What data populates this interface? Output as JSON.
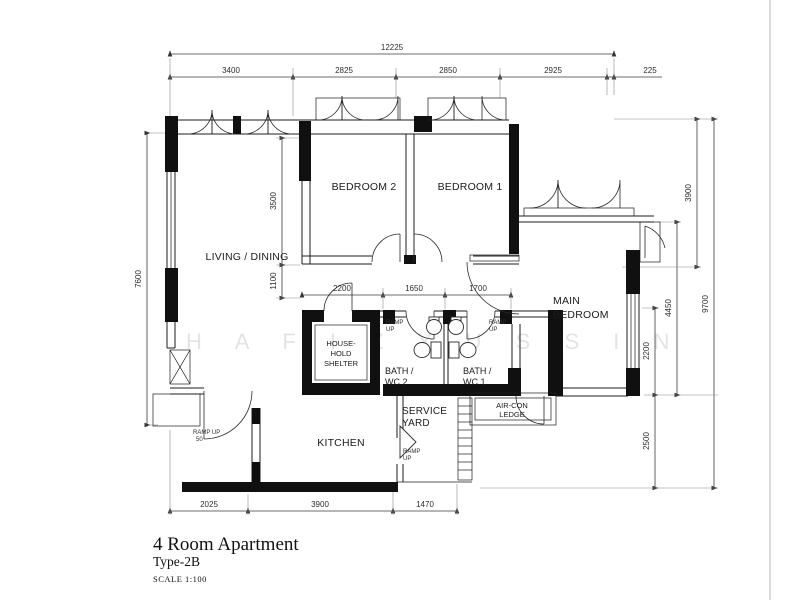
{
  "watermark": "H A F I Z   Y U S S I N",
  "title_block": {
    "title": "4 Room Apartment",
    "type_label": "Type-2B",
    "scale_label": "SCALE 1:100"
  },
  "rooms": {
    "living_dining": "LIVING / DINING",
    "bedroom2": "BEDROOM 2",
    "bedroom1": "BEDROOM 1",
    "main_bedroom_l1": "MAIN",
    "main_bedroom_l2": "BEDROOM",
    "shelter_l1": "HOUSE-",
    "shelter_l2": "HOLD",
    "shelter_l3": "SHELTER",
    "bath2_l1": "BATH /",
    "bath2_l2": "WC 2",
    "bath1_l1": "BATH /",
    "bath1_l2": "WC 1",
    "service_l1": "SERVICE",
    "service_l2": "YARD",
    "aircon_l1": "AIR-CON",
    "aircon_l2": "LEDGE",
    "kitchen": "KITCHEN"
  },
  "ramps": {
    "bath2_l1": "RAMP",
    "bath2_l2": "UP",
    "bath1_l1": "RAMP",
    "bath1_l2": "UP",
    "service_l1": "RAMP",
    "service_l2": "UP",
    "entrance_l1": "RAMP UP",
    "entrance_l2": "50"
  },
  "dimensions": {
    "top_total": "12225",
    "top": [
      "3400",
      "2825",
      "2850",
      "2925",
      "225"
    ],
    "left_height": "7600",
    "right": {
      "upper": "3900",
      "overall": "9700",
      "mid": "4450",
      "window": "2200",
      "lower": "2500"
    },
    "corridor": [
      "2200",
      "1650",
      "1700"
    ],
    "bedroom2_height": "3500",
    "corridor_width": "1100",
    "bottom": [
      "2025",
      "3900",
      "1470"
    ]
  }
}
